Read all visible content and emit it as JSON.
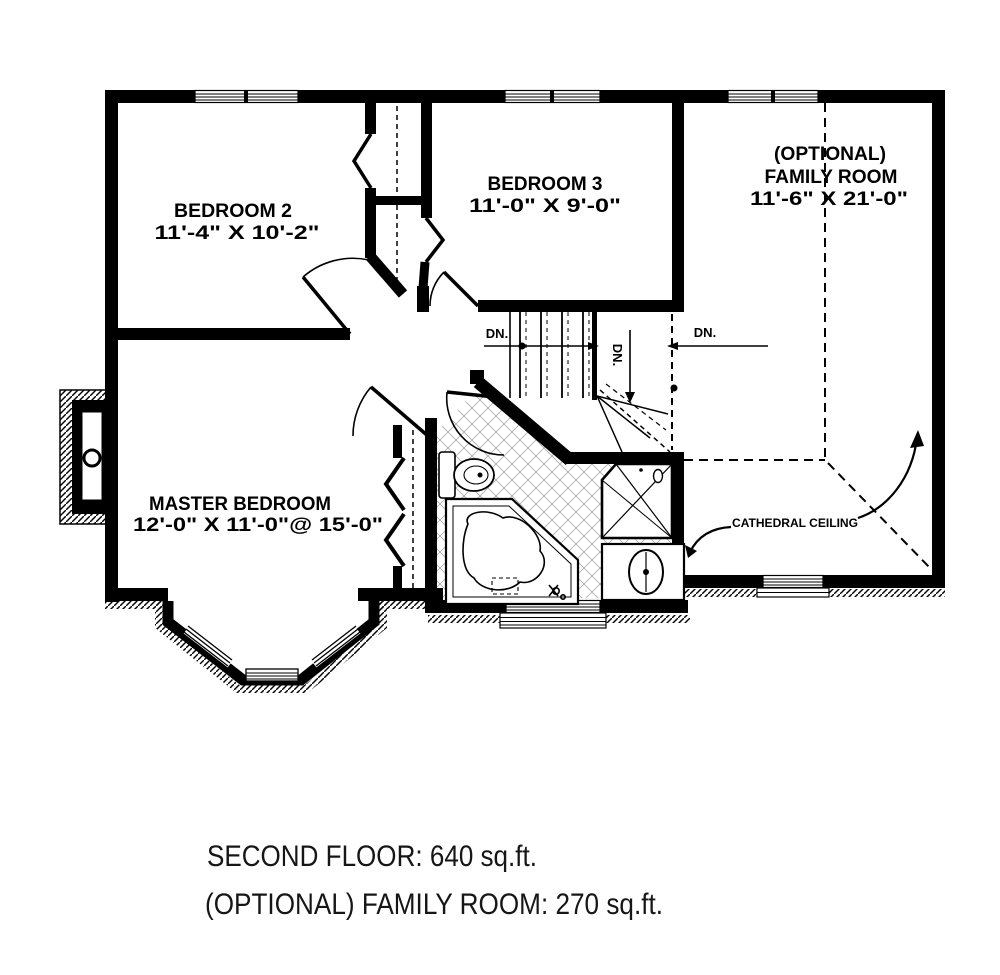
{
  "rooms": {
    "bedroom2": {
      "name": "BEDROOM 2",
      "dims": "11'-4\" X 10'-2\""
    },
    "bedroom3": {
      "name": "BEDROOM 3",
      "dims": "11'-0\" X 9'-0\""
    },
    "family_room": {
      "line1": "(OPTIONAL)",
      "line2": "FAMILY ROOM",
      "dims": "11'-6\" X 21'-0\""
    },
    "master_bedroom": {
      "name": "MASTER BEDROOM",
      "dims": "12'-0\" X 11'-0\"@ 15'-0\""
    }
  },
  "annotations": {
    "down_label": "DN.",
    "cathedral_ceiling": "CATHEDRAL CEILING"
  },
  "captions": {
    "second_floor": "SECOND FLOOR: 640 sq.ft.",
    "optional_family_room": "(OPTIONAL) FAMILY ROOM: 270 sq.ft."
  },
  "colors": {
    "ink": "#000000",
    "background": "#ffffff",
    "tile_line": "#999999"
  }
}
